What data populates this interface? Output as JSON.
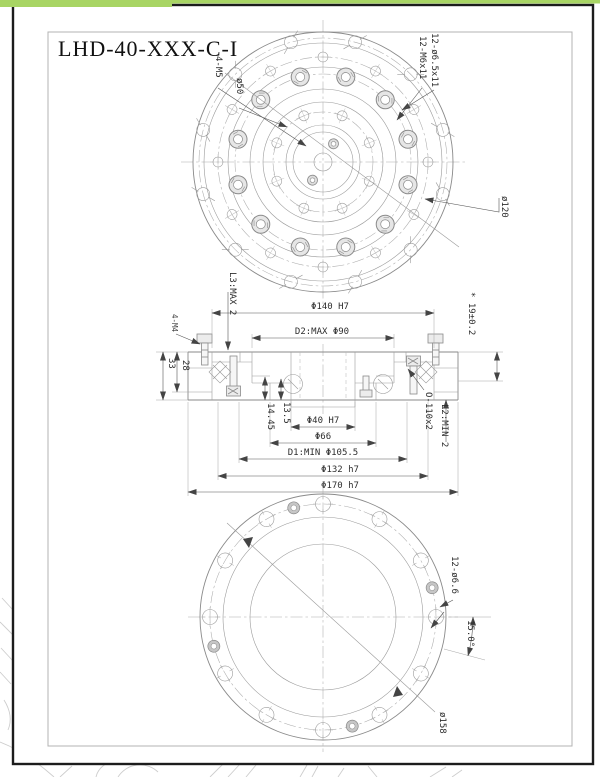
{
  "title": "LHD-40-XXX-C-I",
  "colors": {
    "accent_green": "#a8d564",
    "sheet_border": "#1c1c1c",
    "line_gray": "#8a8a8a"
  },
  "top_view": {
    "label_4m5": "4-M5",
    "label_d50": "ø50",
    "label_holes_cbore": "12-ø6.5x11",
    "label_holes_tapped": "12-M6x11",
    "label_d120": "ø120"
  },
  "section_view": {
    "label_l3": "L3:MAX 2",
    "label_d140": "Φ140 H7",
    "label_d2": "D2:MAX Φ90",
    "label_19": "* 19±0.2",
    "label_4m4": "4-M4",
    "label_33": "33",
    "label_28": "28",
    "label_1445": "14.45",
    "label_135": "13.5",
    "label_d40": "Φ40 H7",
    "label_d66": "Φ66",
    "label_d1": "D1:MIN Φ105.5",
    "label_d132": "Φ132 h7",
    "label_d170": "Φ170 h7",
    "label_oring": "O-110x2",
    "label_l2": "L2:MIN 2"
  },
  "bottom_view": {
    "label_holes": "12-ø6.6",
    "label_angle": "15.0°",
    "label_d158": "ø158"
  }
}
